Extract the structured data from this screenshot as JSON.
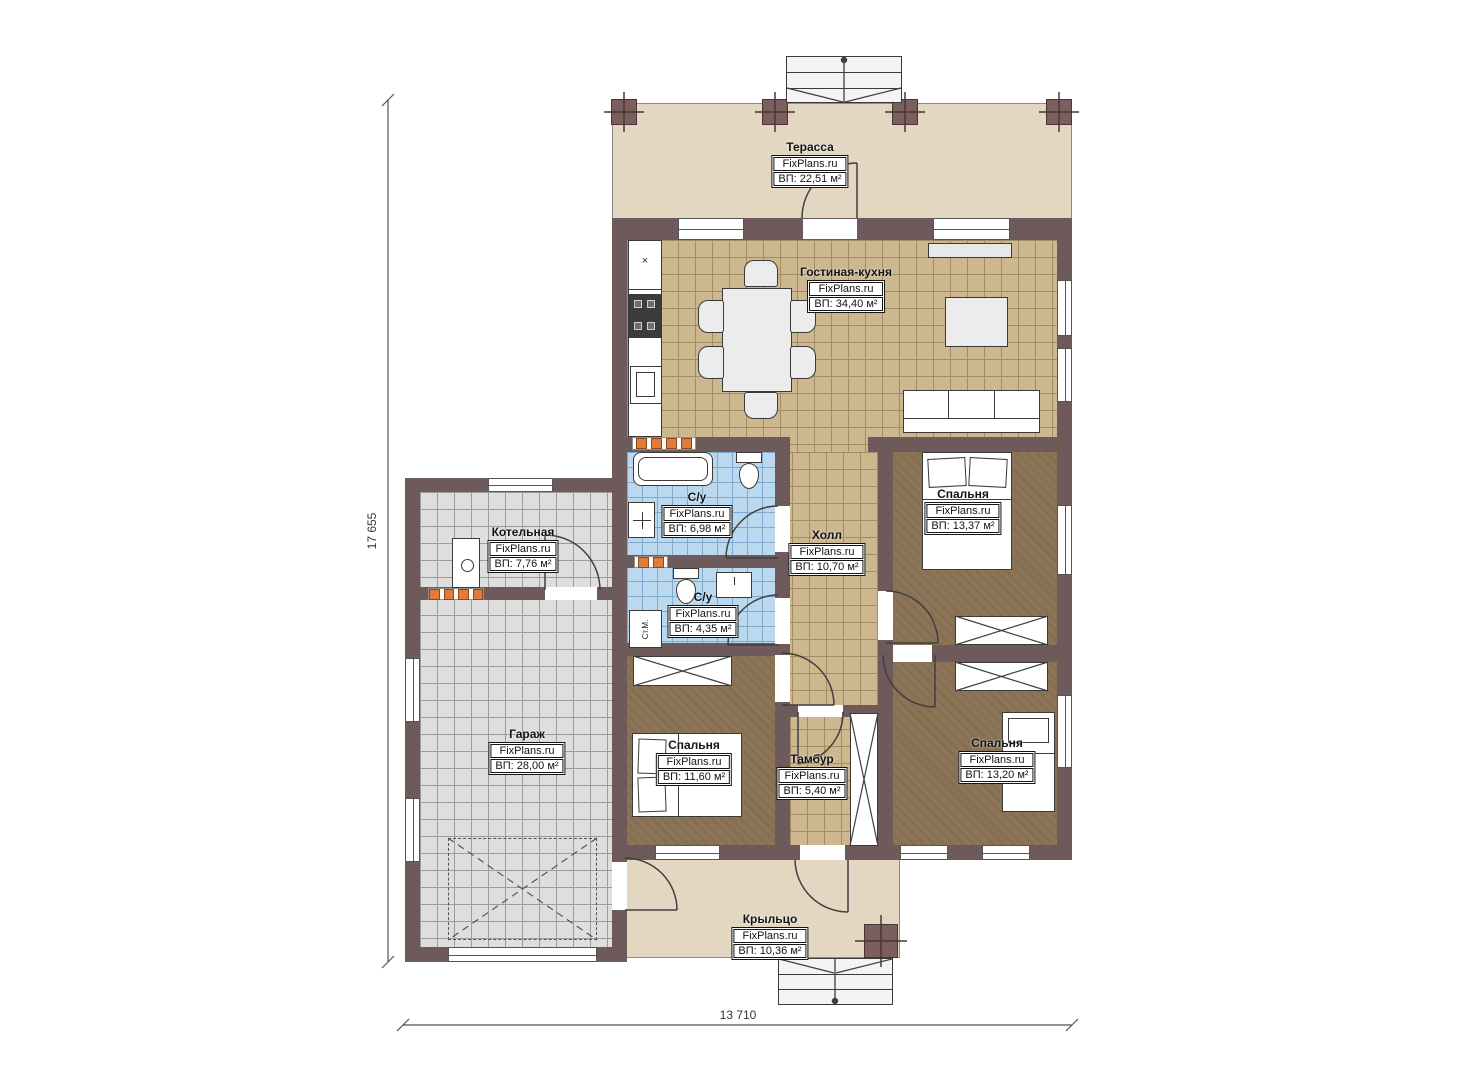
{
  "brand": "FixPlans.ru",
  "rooms": [
    {
      "id": "terrace",
      "name": "Терасса",
      "area": "ВП: 22,51 м²"
    },
    {
      "id": "living-kitchen",
      "name": "Гостиная-кухня",
      "area": "ВП: 34,40 м²"
    },
    {
      "id": "boiler-room",
      "name": "Котельная",
      "area": "ВП: 7,76 м²"
    },
    {
      "id": "bathroom-1",
      "name": "С/у",
      "area": "ВП: 6,98 м²"
    },
    {
      "id": "hall",
      "name": "Холл",
      "area": "ВП: 10,70 м²"
    },
    {
      "id": "bedroom-top-right",
      "name": "Спальня",
      "area": "ВП: 13,37 м²"
    },
    {
      "id": "bathroom-2",
      "name": "С/у",
      "area": "ВП: 4,35 м²"
    },
    {
      "id": "garage",
      "name": "Гараж",
      "area": "ВП: 28,00 м²"
    },
    {
      "id": "bedroom-bottom-left",
      "name": "Спальня",
      "area": "ВП: 11,60 м²"
    },
    {
      "id": "vestibule",
      "name": "Тамбур",
      "area": "ВП: 5,40 м²"
    },
    {
      "id": "bedroom-bottom-right",
      "name": "Спальня",
      "area": "ВП: 13,20 м²"
    },
    {
      "id": "porch",
      "name": "Крыльцо",
      "area": "ВП: 10,36 м²"
    }
  ],
  "dimensions": {
    "height_mm": "17 655",
    "width_mm": "13 710"
  },
  "annotations": {
    "washing_machine": "Ст.М.",
    "cabinet_mark": "×"
  },
  "colors": {
    "wall": "#6f5a5b",
    "tile_tan": "#cdb78e",
    "tile_blue": "#bad9ef",
    "tile_gray": "#dedede",
    "floor_brown": "#8c7557",
    "floor_beige": "#e3d7c2",
    "radiator": "#e07b3a"
  }
}
